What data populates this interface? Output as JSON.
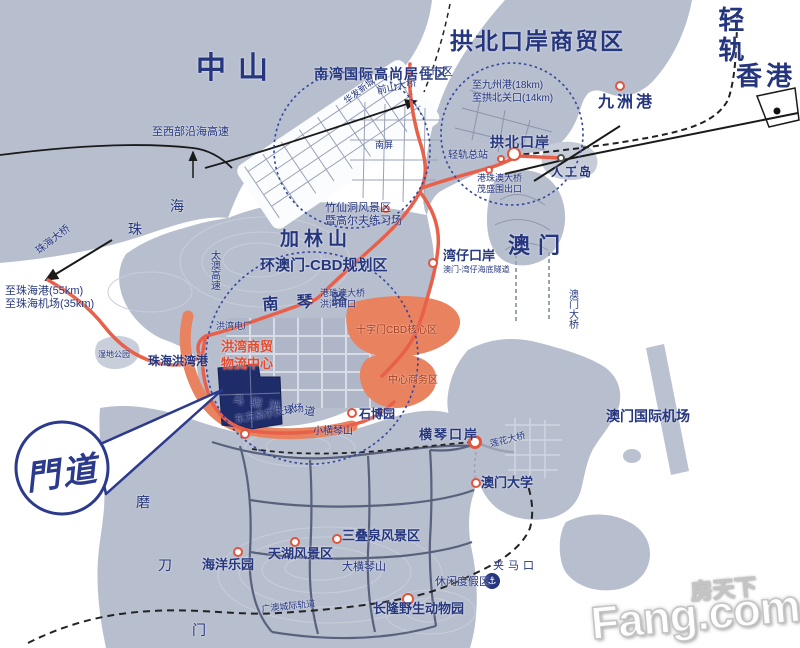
{
  "colors": {
    "navy": "#25367f",
    "red": "#e84a2d",
    "cbd": "#a83a1a",
    "marker_stroke": "#e2553d",
    "land": "#b7bece",
    "land_dark": "#aeb6c7",
    "road_red": "#e8604a",
    "zone_orange": "#e8825f",
    "site_navy": "#1f2c6a"
  },
  "logo": {
    "text": "門道"
  },
  "watermark": {
    "cn": "房天下",
    "en": "Fang.com"
  },
  "anchor_icon": {
    "glyph": "⚓"
  },
  "map": {
    "labels": [
      {
        "id": "zhongshan",
        "t": "中山",
        "x": 196,
        "y": 52,
        "s": 30,
        "b": 1,
        "ls": 12
      },
      {
        "id": "qinggui",
        "t": "轻轨",
        "x": 714,
        "y": 6,
        "s": 26,
        "b": 1,
        "v": 1,
        "ls": 4
      },
      {
        "id": "gongbei-shangmaoqu",
        "t": "拱北口岸商贸区",
        "x": 450,
        "y": 28,
        "s": 23,
        "b": 1,
        "ls": 2
      },
      {
        "id": "xianggang",
        "t": "香港",
        "x": 736,
        "y": 62,
        "s": 26,
        "b": 1,
        "ls": 4
      },
      {
        "id": "aomen",
        "t": "澳门",
        "x": 508,
        "y": 233,
        "s": 22,
        "b": 1,
        "ls": 8
      },
      {
        "id": "jialinshan",
        "t": "加林山",
        "x": 280,
        "y": 229,
        "s": 19,
        "b": 1,
        "ls": 5
      },
      {
        "id": "nanwan-juzhuqu",
        "t": "南湾国际高尚居住区",
        "x": 314,
        "y": 66,
        "s": 14,
        "b": 1,
        "ls": 1
      },
      {
        "id": "zhi-shiqu",
        "t": "至市区",
        "x": 420,
        "y": 66,
        "s": 11
      },
      {
        "id": "zhi-jiuzhougang",
        "t": "至九州港(18km)",
        "x": 472,
        "y": 80,
        "s": 10
      },
      {
        "id": "zhi-gongbei-guankou",
        "t": "至拱北关口(14km)",
        "x": 472,
        "y": 93,
        "s": 10
      },
      {
        "id": "jiuzhougang",
        "t": "九洲港",
        "x": 598,
        "y": 94,
        "s": 16,
        "b": 1,
        "ls": 3
      },
      {
        "id": "gongbei-kouan",
        "t": "拱北口岸",
        "x": 490,
        "y": 134,
        "s": 14,
        "b": 1,
        "ls": 1
      },
      {
        "id": "qinggui-zongzhan",
        "t": "轻轨总站",
        "x": 448,
        "y": 150,
        "s": 10
      },
      {
        "id": "rengongdao",
        "t": "人工岛",
        "x": 551,
        "y": 166,
        "s": 12,
        "b": 1,
        "ls": 2
      },
      {
        "id": "maoshengwei-chukou",
        "t": "港珠澳大桥\n茂盛围出口",
        "x": 477,
        "y": 173,
        "s": 9,
        "lh": 11
      },
      {
        "id": "qianshan-daqiao",
        "t": "前山大桥",
        "x": 376,
        "y": 86,
        "s": 10,
        "r": -12
      },
      {
        "id": "huafa-xincheng",
        "t": "华发新城",
        "x": 342,
        "y": 98,
        "s": 9,
        "r": -38
      },
      {
        "id": "nanping",
        "t": "南屏",
        "x": 375,
        "y": 140,
        "s": 9
      },
      {
        "id": "zhu-char",
        "t": "珠",
        "x": 128,
        "y": 221,
        "s": 14
      },
      {
        "id": "hai-char",
        "t": "海",
        "x": 170,
        "y": 198,
        "s": 14
      },
      {
        "id": "zhi-xibu-gaosu",
        "t": "至西部沿海高速",
        "x": 152,
        "y": 126,
        "s": 11
      },
      {
        "id": "zhuhai-daqiao",
        "t": "珠海大桥",
        "x": 34,
        "y": 248,
        "s": 10,
        "r": -38
      },
      {
        "id": "zhi-zhuhaigang",
        "t": "至珠海港(55km)",
        "x": 5,
        "y": 285,
        "s": 11
      },
      {
        "id": "zhi-zhuhai-jichang",
        "t": "至珠海机场(35km)",
        "x": 5,
        "y": 298,
        "s": 11
      },
      {
        "id": "taiao-gaosu",
        "t": "太澳高速",
        "x": 208,
        "y": 250,
        "s": 10,
        "v": 1
      },
      {
        "id": "zhuxiandong",
        "t": "竹仙洞风景区\n暨高尔夫练习场",
        "x": 325,
        "y": 202,
        "s": 11,
        "lh": 13
      },
      {
        "id": "huan-aomen-cbd",
        "t": "环澳门-CBD规划区",
        "x": 260,
        "y": 257,
        "s": 15,
        "b": 1
      },
      {
        "id": "wanzai-kouan",
        "t": "湾仔口岸",
        "x": 443,
        "y": 249,
        "s": 13,
        "b": 1
      },
      {
        "id": "haidi-suidao",
        "t": "澳门-湾仔海底隧道",
        "x": 443,
        "y": 265,
        "s": 8
      },
      {
        "id": "aomen-daqiao",
        "t": "澳门大桥",
        "x": 566,
        "y": 289,
        "s": 10,
        "v": 1
      },
      {
        "id": "nanqinlu",
        "t": "南 琴 路",
        "x": 262,
        "y": 297,
        "s": 16,
        "b": 1,
        "ls": 7,
        "r": -4
      },
      {
        "id": "hongwan-chukou",
        "t": "港珠澳大桥\n洪湾出口",
        "x": 320,
        "y": 288,
        "s": 9,
        "lh": 11
      },
      {
        "id": "hongwan-dianchang",
        "t": "洪湾电厂",
        "x": 216,
        "y": 321,
        "s": 9
      },
      {
        "id": "shizimen-cbd",
        "t": "十字门CBD核心区",
        "x": 356,
        "y": 325,
        "s": 10,
        "c": "cbd"
      },
      {
        "id": "zhongxin-shangwuqu",
        "t": "中心商务区",
        "x": 388,
        "y": 375,
        "s": 10,
        "c": "cbd"
      },
      {
        "id": "hongwan-shangmao",
        "t": "洪湾商贸\n物流中心",
        "x": 221,
        "y": 338,
        "s": 13,
        "b": 1,
        "c": "red",
        "lh": 17
      },
      {
        "id": "maliuzhou-shuidao",
        "t": "马骝洲水道",
        "x": 234,
        "y": 394,
        "s": 11,
        "ls": 7,
        "r": 9
      },
      {
        "id": "zhuhai-hongwangang",
        "t": "珠海洪湾港",
        "x": 148,
        "y": 355,
        "s": 12,
        "b": 1
      },
      {
        "id": "shidi-gongyuan",
        "t": "湿地公园",
        "x": 98,
        "y": 350,
        "s": 8
      },
      {
        "id": "shiboyuan",
        "t": "石博园",
        "x": 359,
        "y": 408,
        "s": 12,
        "b": 1
      },
      {
        "id": "dongfang-golf",
        "t": "东方高尔夫球场",
        "x": 234,
        "y": 415,
        "s": 10,
        "r": -10
      },
      {
        "id": "xiao-hengqinshan",
        "t": "小横琴山",
        "x": 313,
        "y": 426,
        "s": 10
      },
      {
        "id": "hengqin-kouan",
        "t": "横琴口岸",
        "x": 419,
        "y": 428,
        "s": 13,
        "b": 1,
        "ls": 2
      },
      {
        "id": "lianhua-daqiao",
        "t": "莲花大桥",
        "x": 489,
        "y": 439,
        "s": 9,
        "r": -14
      },
      {
        "id": "aomen-daxue",
        "t": "澳门大学",
        "x": 481,
        "y": 476,
        "s": 13,
        "b": 1
      },
      {
        "id": "aomen-jichang",
        "t": "澳门国际机场",
        "x": 606,
        "y": 408,
        "s": 14,
        "b": 1
      },
      {
        "id": "mo-char",
        "t": "磨",
        "x": 136,
        "y": 494,
        "s": 14
      },
      {
        "id": "dao-char",
        "t": "刀",
        "x": 158,
        "y": 557,
        "s": 14
      },
      {
        "id": "men-char",
        "t": "门",
        "x": 192,
        "y": 622,
        "s": 14
      },
      {
        "id": "haiyang-leyuan",
        "t": "海洋乐园",
        "x": 202,
        "y": 558,
        "s": 13,
        "b": 1
      },
      {
        "id": "tianhu-fengjingqu",
        "t": "天湖风景区",
        "x": 268,
        "y": 547,
        "s": 13,
        "b": 1
      },
      {
        "id": "sandiequan",
        "t": "三叠泉风景区",
        "x": 342,
        "y": 529,
        "s": 13,
        "b": 1
      },
      {
        "id": "da-hengqinshan",
        "t": "大横琴山",
        "x": 342,
        "y": 561,
        "s": 11
      },
      {
        "id": "changlong",
        "t": "长隆野生动物园",
        "x": 373,
        "y": 602,
        "s": 13,
        "b": 1
      },
      {
        "id": "xiuxian-dujiaqu",
        "t": "休闲度假区",
        "x": 435,
        "y": 576,
        "s": 11
      },
      {
        "id": "guangao-guidao",
        "t": "广澳城际轨道",
        "x": 261,
        "y": 604,
        "s": 9,
        "r": -6
      },
      {
        "id": "jiamakou",
        "t": "夹马口",
        "x": 493,
        "y": 560,
        "s": 11,
        "ls": 4
      }
    ],
    "markers": [
      {
        "id": "jiuzhougang",
        "x": 620,
        "y": 86,
        "r": 5
      },
      {
        "id": "gongbei-kouan",
        "x": 514,
        "y": 154,
        "r": 7
      },
      {
        "id": "qinggui-zongzhan",
        "x": 501,
        "y": 159,
        "r": 4
      },
      {
        "id": "rengongdao",
        "x": 561,
        "y": 158,
        "r": 4,
        "s": "#555555"
      },
      {
        "id": "maoshengwei-chukou",
        "x": 489,
        "y": 170,
        "r": 4
      },
      {
        "id": "hongwan-chukou",
        "x": 310,
        "y": 301,
        "r": 4
      },
      {
        "id": "wanzai-kouan",
        "x": 433,
        "y": 263,
        "r": 5
      },
      {
        "id": "zhuxiandong",
        "x": 386,
        "y": 209,
        "r": 4
      },
      {
        "id": "hengqin-kouan",
        "x": 475,
        "y": 442,
        "r": 7,
        "w": 3
      },
      {
        "id": "aomen-daxue",
        "x": 476,
        "y": 483,
        "r": 5
      },
      {
        "id": "shiboyuan",
        "x": 352,
        "y": 413,
        "r": 5
      },
      {
        "id": "dongfang-golf",
        "x": 245,
        "y": 434,
        "r": 5
      },
      {
        "id": "tianhu",
        "x": 295,
        "y": 542,
        "r": 5
      },
      {
        "id": "sandiequan",
        "x": 337,
        "y": 539,
        "r": 5
      },
      {
        "id": "haiyang-leyuan",
        "x": 238,
        "y": 552,
        "r": 5
      },
      {
        "id": "changlong",
        "x": 408,
        "y": 599,
        "r": 6
      }
    ]
  }
}
